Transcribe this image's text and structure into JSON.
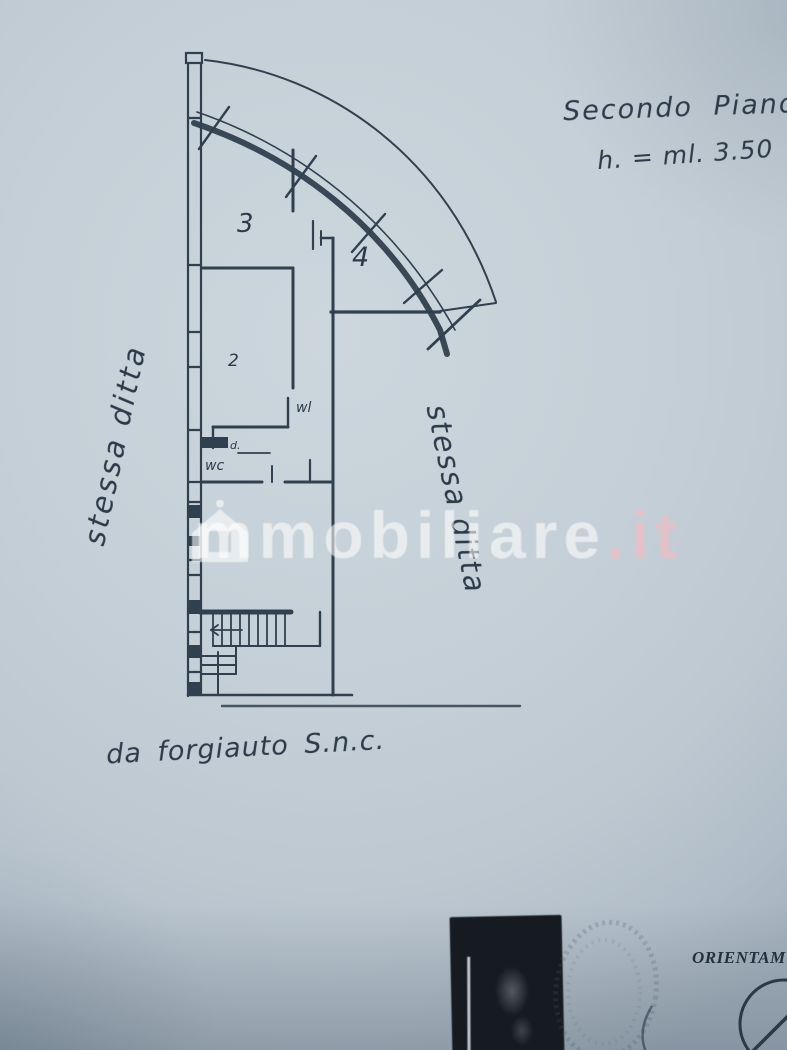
{
  "photo": {
    "type": "scanned floor plan photograph",
    "paper_color": "#c5cfd7",
    "ink_color": "#31404f"
  },
  "titles": {
    "floor": "Secondo Piano",
    "height": "h. = ml. 3.50"
  },
  "notes": {
    "left": "stessa ditta",
    "right": "stessa ditta",
    "bottom": "da forgiauto S.n.c."
  },
  "plan_labels": {
    "room3": "3",
    "room2": "2",
    "room4": "4",
    "small_wl": "wl",
    "small_d": "d.",
    "small_wc": "wc"
  },
  "watermark": {
    "brand": "immobiliare.it",
    "text_main": "mmobiliare",
    "text_suffix": ".it",
    "color": "#ffffff"
  },
  "stamps": {
    "orientation_label": "ORIENTAM"
  }
}
